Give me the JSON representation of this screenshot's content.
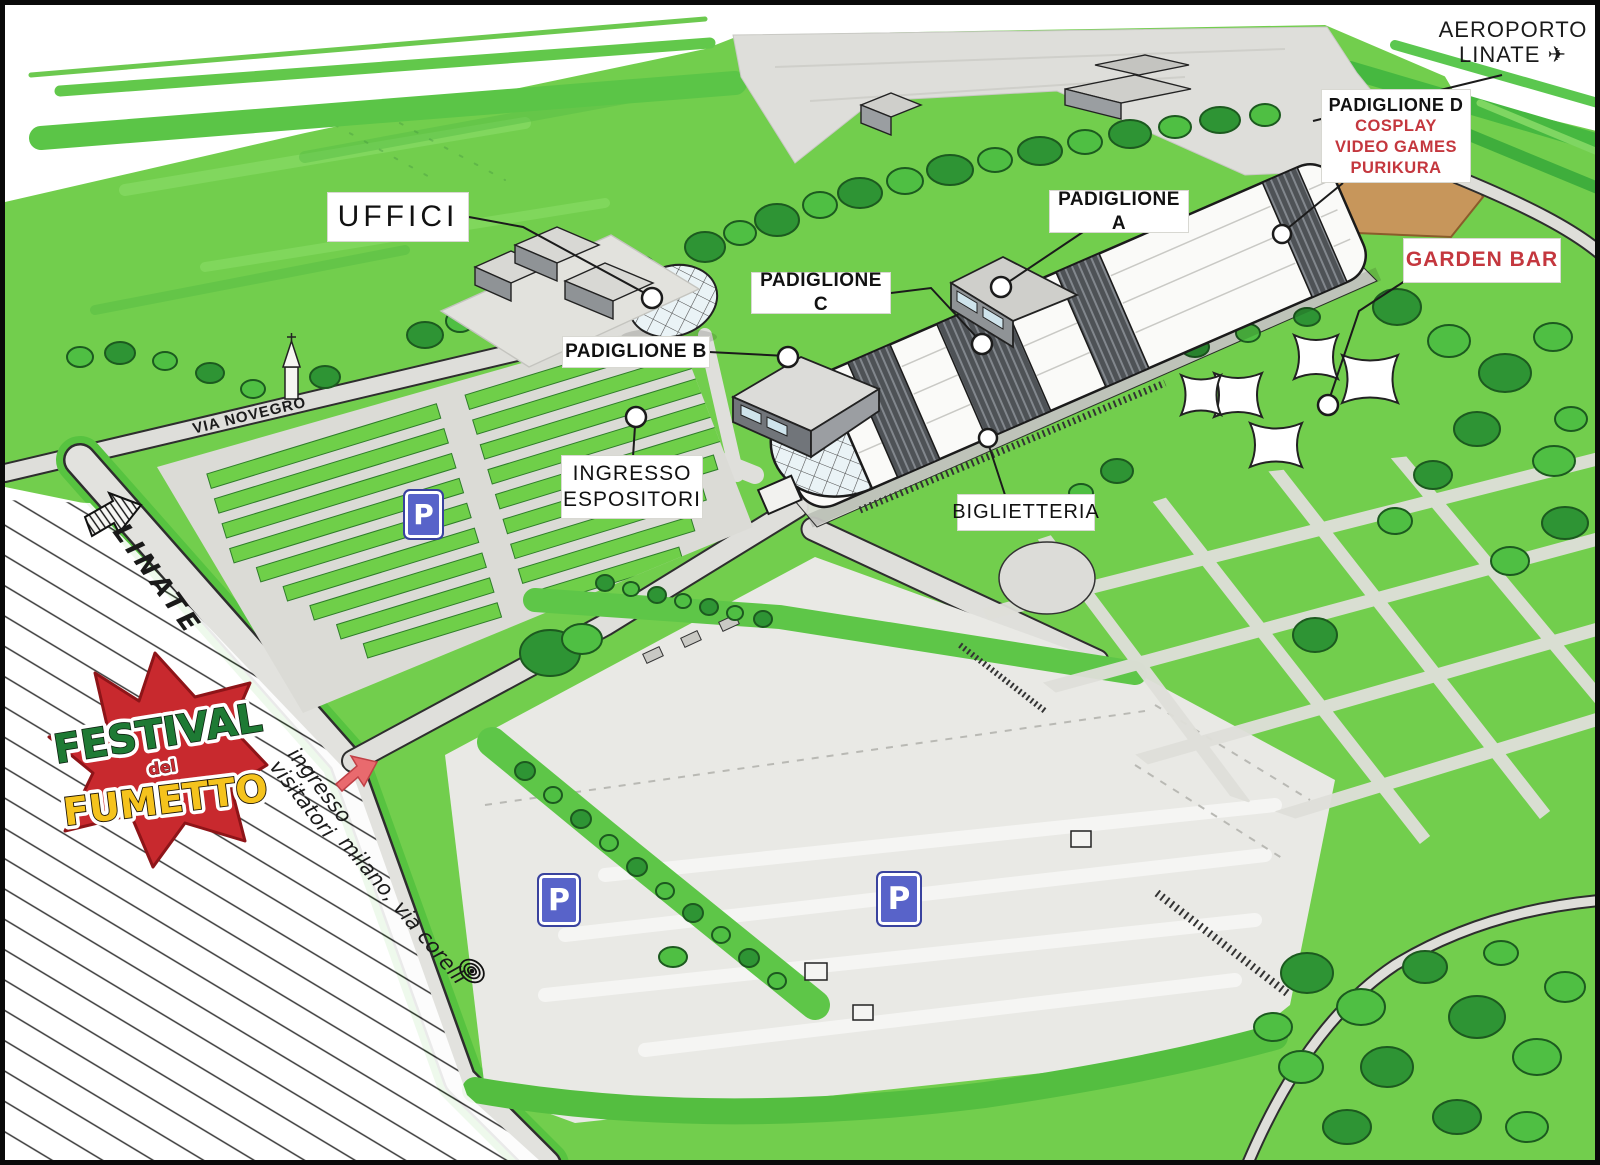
{
  "map": {
    "logo": {
      "line1": "FESTIVAL",
      "line2": "del",
      "line3": "FUMETTO"
    },
    "callouts": {
      "uffici": {
        "label": "UFFICI"
      },
      "padiglione_a": {
        "label": "PADIGLIONE A"
      },
      "padiglione_b": {
        "label": "PADIGLIONE B"
      },
      "padiglione_c": {
        "label": "PADIGLIONE C"
      },
      "padiglione_d": {
        "title": "PADIGLIONE D",
        "lines": [
          "COSPLAY",
          "VIDEO GAMES",
          "PURIKURA"
        ]
      },
      "garden_bar": {
        "label": "GARDEN BAR"
      },
      "ingresso_espositori": {
        "line1": "INGRESSO",
        "line2": "ESPOSITORI"
      },
      "biglietteria": {
        "label": "BIGLIETTERIA"
      },
      "aeroporto": {
        "line1": "AEROPORTO",
        "line2": "LINATE",
        "icon": "✈"
      }
    },
    "roads": {
      "via_novegro": "VIA NOVEGRO",
      "linate": "LINATE",
      "ingresso_visitatori_line1": "ingresso",
      "ingresso_visitatori_line2": "visitatori",
      "milano_via_corelli": "milano, via corelli"
    },
    "parking": {
      "sign": "P"
    },
    "colors": {
      "field_green": "#72CE4D",
      "dark_tree_green": "#2E9434",
      "road_gray": "#DEDEDA",
      "accent_red": "#C4373E",
      "parking_blue": "#5863C9",
      "dirt_tan": "#C7965B"
    }
  }
}
